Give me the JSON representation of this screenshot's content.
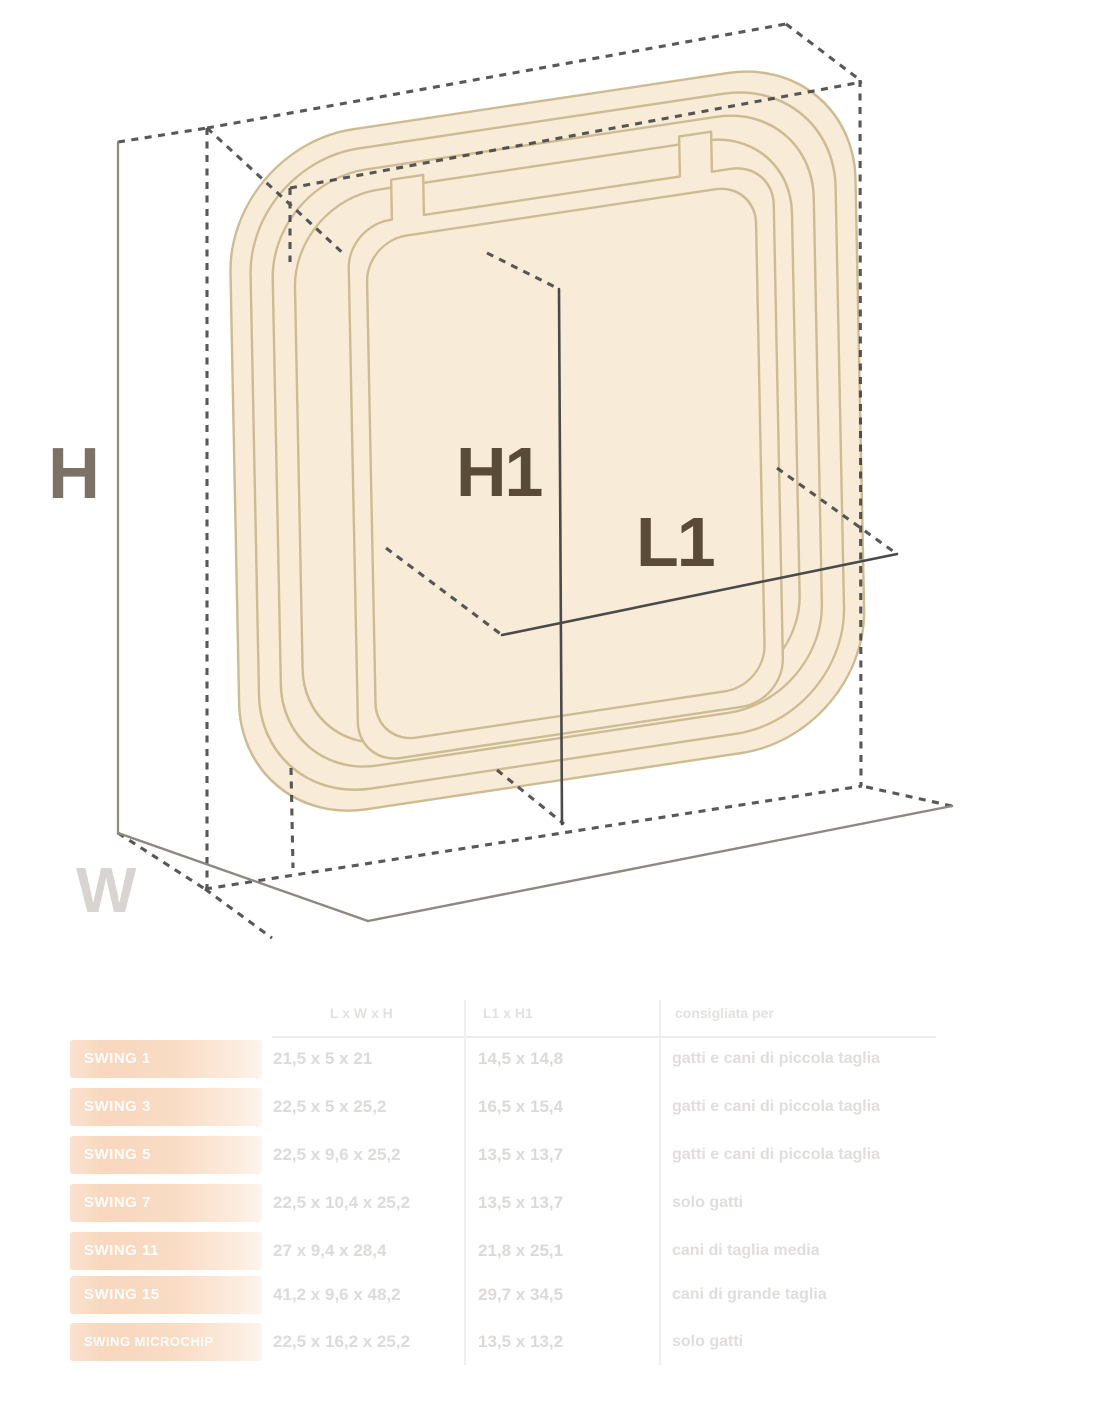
{
  "diagram": {
    "labels": {
      "height": "H",
      "inner_height": "H1",
      "inner_length": "L1",
      "width": "W"
    },
    "colors": {
      "door_fill": "#f8ecd9",
      "door_stroke": "#cdbb92",
      "dash_line": "#414141",
      "dim_line": "#4a4a4a",
      "label_dark_brown": "#5a4b39",
      "label_gray_brown": "#7b7166",
      "label_light_gray": "#d8d5d0"
    }
  },
  "table": {
    "headers": {
      "model": "",
      "dimensions": "L x W x H",
      "opening": "L1 x H1",
      "recommended": "consigliata per"
    },
    "rows": [
      {
        "model": "SWING 1",
        "dimensions": "21,5 x 5 x 21",
        "opening": "14,5 x 14,8",
        "recommended": "gatti e cani di piccola taglia"
      },
      {
        "model": "SWING 3",
        "dimensions": "22,5 x 5 x 25,2",
        "opening": "16,5 x 15,4",
        "recommended": "gatti e cani di piccola taglia"
      },
      {
        "model": "SWING 5",
        "dimensions": "22,5 x 9,6 x 25,2",
        "opening": "13,5 x 13,7",
        "recommended": "gatti e cani di piccola taglia"
      },
      {
        "model": "SWING 7",
        "dimensions": "22,5 x 10,4 x 25,2",
        "opening": "13,5 x 13,7",
        "recommended": "solo gatti"
      },
      {
        "model": "SWING 11",
        "dimensions": "27 x 9,4 x 28,4",
        "opening": "21,8 x 25,1",
        "recommended": "cani di taglia media"
      },
      {
        "model": "SWING 15",
        "dimensions": "41,2 x 9,6 x 48,2",
        "opening": "29,7 x 34,5",
        "recommended": "cani di grande taglia"
      },
      {
        "model": "SWING MICROCHIP",
        "dimensions": "22,5 x 16,2 x 25,2",
        "opening": "13,5 x 13,2",
        "recommended": "solo gatti"
      }
    ]
  }
}
